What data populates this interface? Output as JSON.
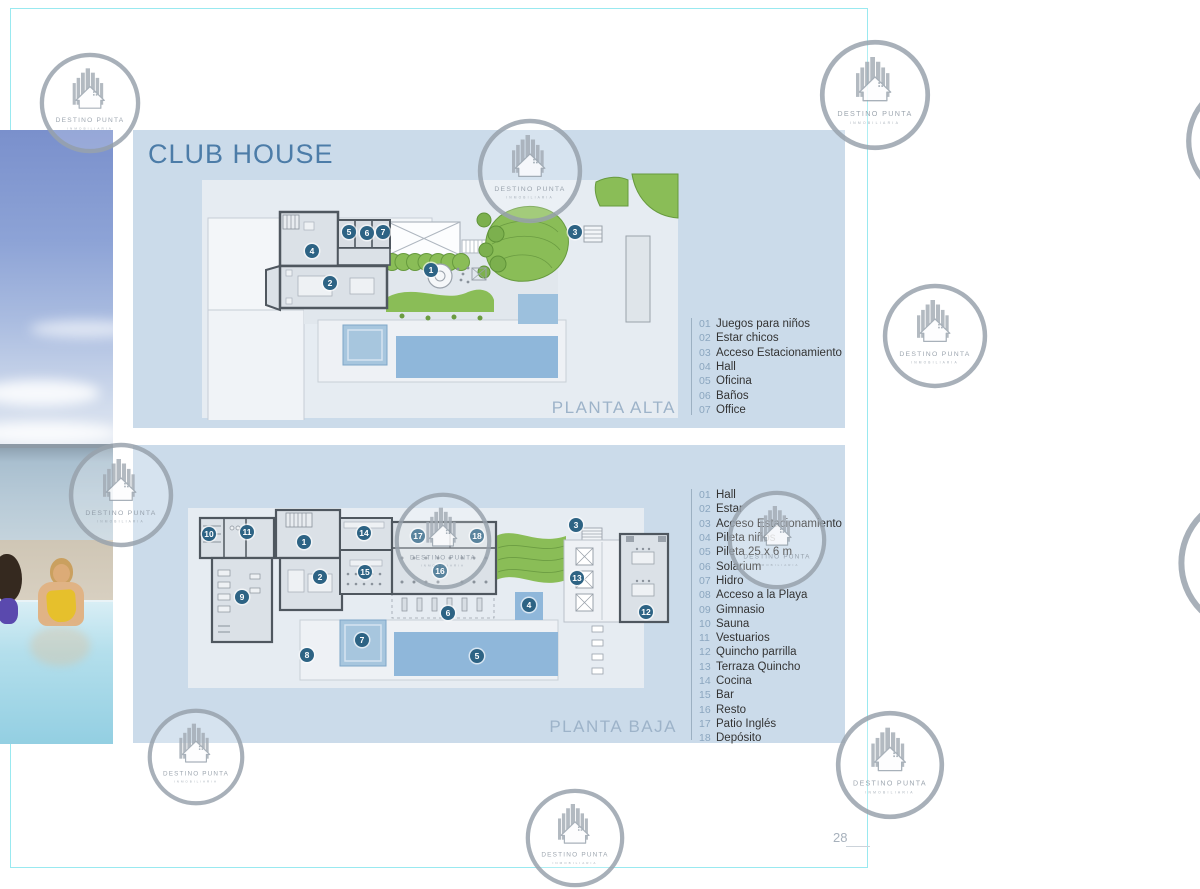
{
  "page": {
    "title": "CLUB HOUSE",
    "number": "28"
  },
  "watermark": {
    "line1": "DESTINO PUNTA",
    "line2": "INMOBILIARIA"
  },
  "plans": [
    {
      "id": "alta",
      "label": "PLANTA ALTA",
      "legend": [
        {
          "num": "01",
          "label": "Juegos para niños"
        },
        {
          "num": "02",
          "label": "Estar chicos"
        },
        {
          "num": "03",
          "label": "Acceso Estacionamiento"
        },
        {
          "num": "04",
          "label": "Hall"
        },
        {
          "num": "05",
          "label": "Oficina"
        },
        {
          "num": "06",
          "label": "Baños"
        },
        {
          "num": "07",
          "label": "Office"
        }
      ],
      "markers": [
        "1",
        "2",
        "3",
        "4",
        "5",
        "6",
        "7"
      ]
    },
    {
      "id": "baja",
      "label": "PLANTA BAJA",
      "legend": [
        {
          "num": "01",
          "label": "Hall"
        },
        {
          "num": "02",
          "label": "Estar"
        },
        {
          "num": "03",
          "label": "Acceso Estacionamiento"
        },
        {
          "num": "04",
          "label": "Pileta niños"
        },
        {
          "num": "05",
          "label": "Pileta 25 x 6 m"
        },
        {
          "num": "06",
          "label": "Solarium"
        },
        {
          "num": "07",
          "label": "Hidro"
        },
        {
          "num": "08",
          "label": "Acceso a la Playa"
        },
        {
          "num": "09",
          "label": "Gimnasio"
        },
        {
          "num": "10",
          "label": "Sauna"
        },
        {
          "num": "11",
          "label": "Vestuarios"
        },
        {
          "num": "12",
          "label": "Quincho parrilla"
        },
        {
          "num": "13",
          "label": "Terraza Quincho"
        },
        {
          "num": "14",
          "label": "Cocina"
        },
        {
          "num": "15",
          "label": "Bar"
        },
        {
          "num": "16",
          "label": "Resto"
        },
        {
          "num": "17",
          "label": "Patio Inglés"
        },
        {
          "num": "18",
          "label": "Depósito"
        }
      ],
      "markers": [
        "1",
        "2",
        "3",
        "4",
        "5",
        "6",
        "7",
        "8",
        "9",
        "10",
        "11",
        "12",
        "13",
        "14",
        "15",
        "16",
        "17",
        "18"
      ]
    }
  ],
  "colors": {
    "title_accent": "#4c7ca8",
    "panel": "#cbdbea",
    "marker": "#2d6384",
    "lawn_green": "#8abd57",
    "pool_blue": "#8fb7da",
    "frame_cyan": "#99e9f0"
  }
}
